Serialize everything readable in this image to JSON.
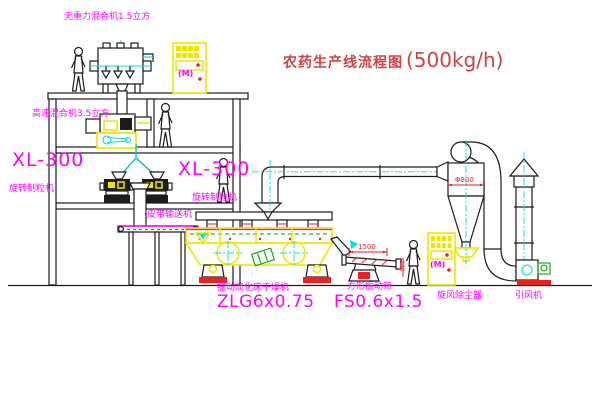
{
  "title": {
    "name": "农药生产线流程图",
    "capacity": "(500kg/h)"
  },
  "equipment": {
    "gravity_mixer": {
      "label": "无重力混合机1.5立方"
    },
    "high_speed_mixer": {
      "label": "高速混合机3.5立方"
    },
    "granulator_left": {
      "model": "XL-300",
      "name": "旋转制粒机"
    },
    "granulator_right": {
      "model": "XL-300",
      "name": "旋转制粒机"
    },
    "belt_conveyor": {
      "name": "皮带输送机"
    },
    "fluid_bed_dryer": {
      "name": "振动流化床干燥机",
      "model": "ZLG6x0.75"
    },
    "vibrating_screen": {
      "name": "方形振动筛",
      "model": "FS0.6x1.5"
    },
    "cyclone": {
      "name": "旋风除尘器",
      "dimension": "Φ800"
    },
    "fan": {
      "name": "引风机"
    },
    "control_cabinet_1": {
      "motor_mark": "(M)"
    },
    "control_cabinet_2": {
      "motor_mark": "(M)"
    }
  },
  "dimensions": {
    "screen_length": "1500",
    "screen_height": "340"
  },
  "colors": {
    "magenta": "#ff00ff",
    "titlered": "#d04343",
    "line": "#1c1c1c",
    "cyan": "#00e0e0",
    "yellow": "#f0e400",
    "red": "#ee2020",
    "green": "#00a400"
  }
}
